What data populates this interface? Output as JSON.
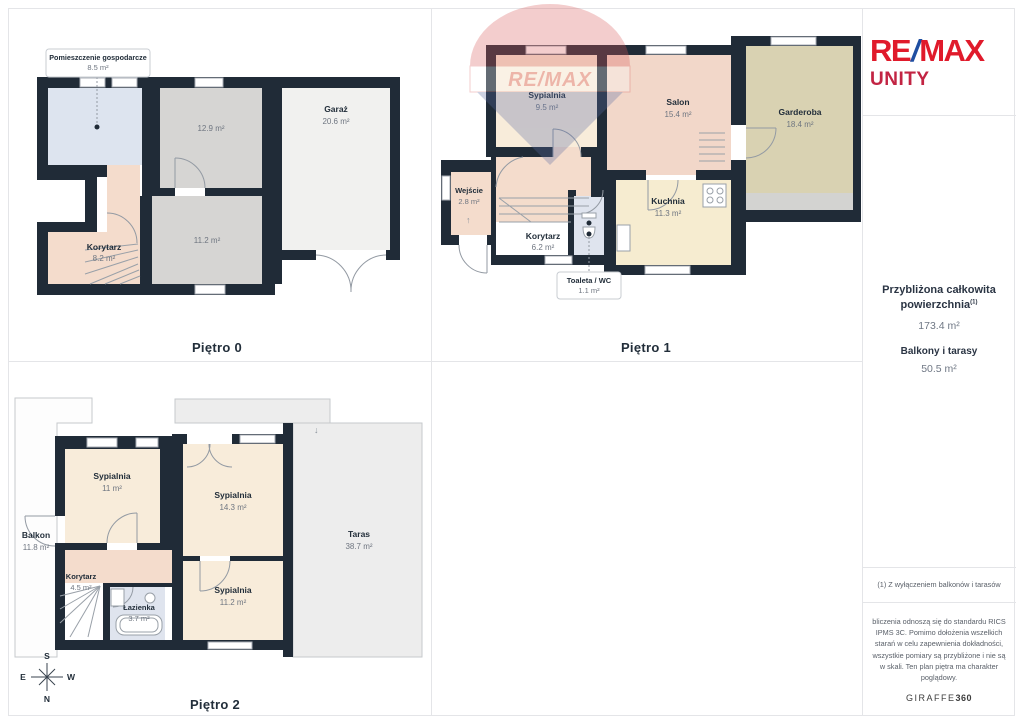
{
  "branding": {
    "agency_re": "RE",
    "agency_slash": "/",
    "agency_max": "MAX",
    "agency_sub": "UNITY",
    "watermark_text": "RE/MAX",
    "colors": {
      "remax_red": "#e01a2b",
      "remax_blue": "#1f4ea1",
      "unity_red": "#c22443",
      "wall_dark": "#202b37",
      "room_cream": "#f8ecda",
      "room_salmon": "#f4dccc",
      "room_gray": "#d6d5d3",
      "room_lightgray": "#f1f1ef",
      "room_blue": "#dde4ef",
      "room_tan": "#d9d2b2",
      "terrace_gray": "#ededed"
    }
  },
  "floors": [
    {
      "label": "Piętro 0",
      "rooms": [
        {
          "name": "Pomieszczenie gospodarcze",
          "area": "8.5 m²"
        },
        {
          "name": "",
          "area": "12.9 m²"
        },
        {
          "name": "Garaż",
          "area": "20.6 m²"
        },
        {
          "name": "",
          "area": "11.2 m²"
        },
        {
          "name": "Korytarz",
          "area": "8.2 m²"
        }
      ]
    },
    {
      "label": "Piętro 1",
      "rooms": [
        {
          "name": "Sypialnia",
          "area": "9.5 m²"
        },
        {
          "name": "Salon",
          "area": "15.4 m²"
        },
        {
          "name": "Garderoba",
          "area": "18.4 m²"
        },
        {
          "name": "Wejście",
          "area": "2.8 m²"
        },
        {
          "name": "Korytarz",
          "area": "6.2 m²"
        },
        {
          "name": "Kuchnia",
          "area": "11.3 m²"
        },
        {
          "name": "Toaleta / WC",
          "area": "1.1 m²"
        }
      ]
    },
    {
      "label": "Piętro 2",
      "rooms": [
        {
          "name": "Sypialnia",
          "area": "11 m²"
        },
        {
          "name": "Sypialnia",
          "area": "14.3 m²"
        },
        {
          "name": "Balkon",
          "area": "11.8 m²"
        },
        {
          "name": "Taras",
          "area": "38.7 m²"
        },
        {
          "name": "Korytarz",
          "area": "4.5 m²"
        },
        {
          "name": "Łazienka",
          "area": "3.7 m²"
        },
        {
          "name": "Sypialnia",
          "area": "11.2 m²"
        }
      ]
    }
  ],
  "compass": {
    "n": "N",
    "s": "S",
    "e": "E",
    "w": "W"
  },
  "sidebar": {
    "total_line1": "Przybliżona całkowita",
    "total_line2": "powierzchnia",
    "total_sup": "(1)",
    "total_value": "173.4 m²",
    "balcony_label": "Balkony i tarasy",
    "balcony_value": "50.5 m²",
    "footnote": "(1) Z wyłączeniem balkonów i tarasów",
    "disclaimer": "bliczenia odnoszą się do standardu RICS IPMS 3C. Pomimo dołożenia wszelkich starań w celu zapewnienia dokładności, wszystkie pomiary są przybliżone i nie są w skali. Ten plan piętra ma charakter poglądowy.",
    "brand": "GIRAFFE",
    "brand_suffix": "360"
  }
}
